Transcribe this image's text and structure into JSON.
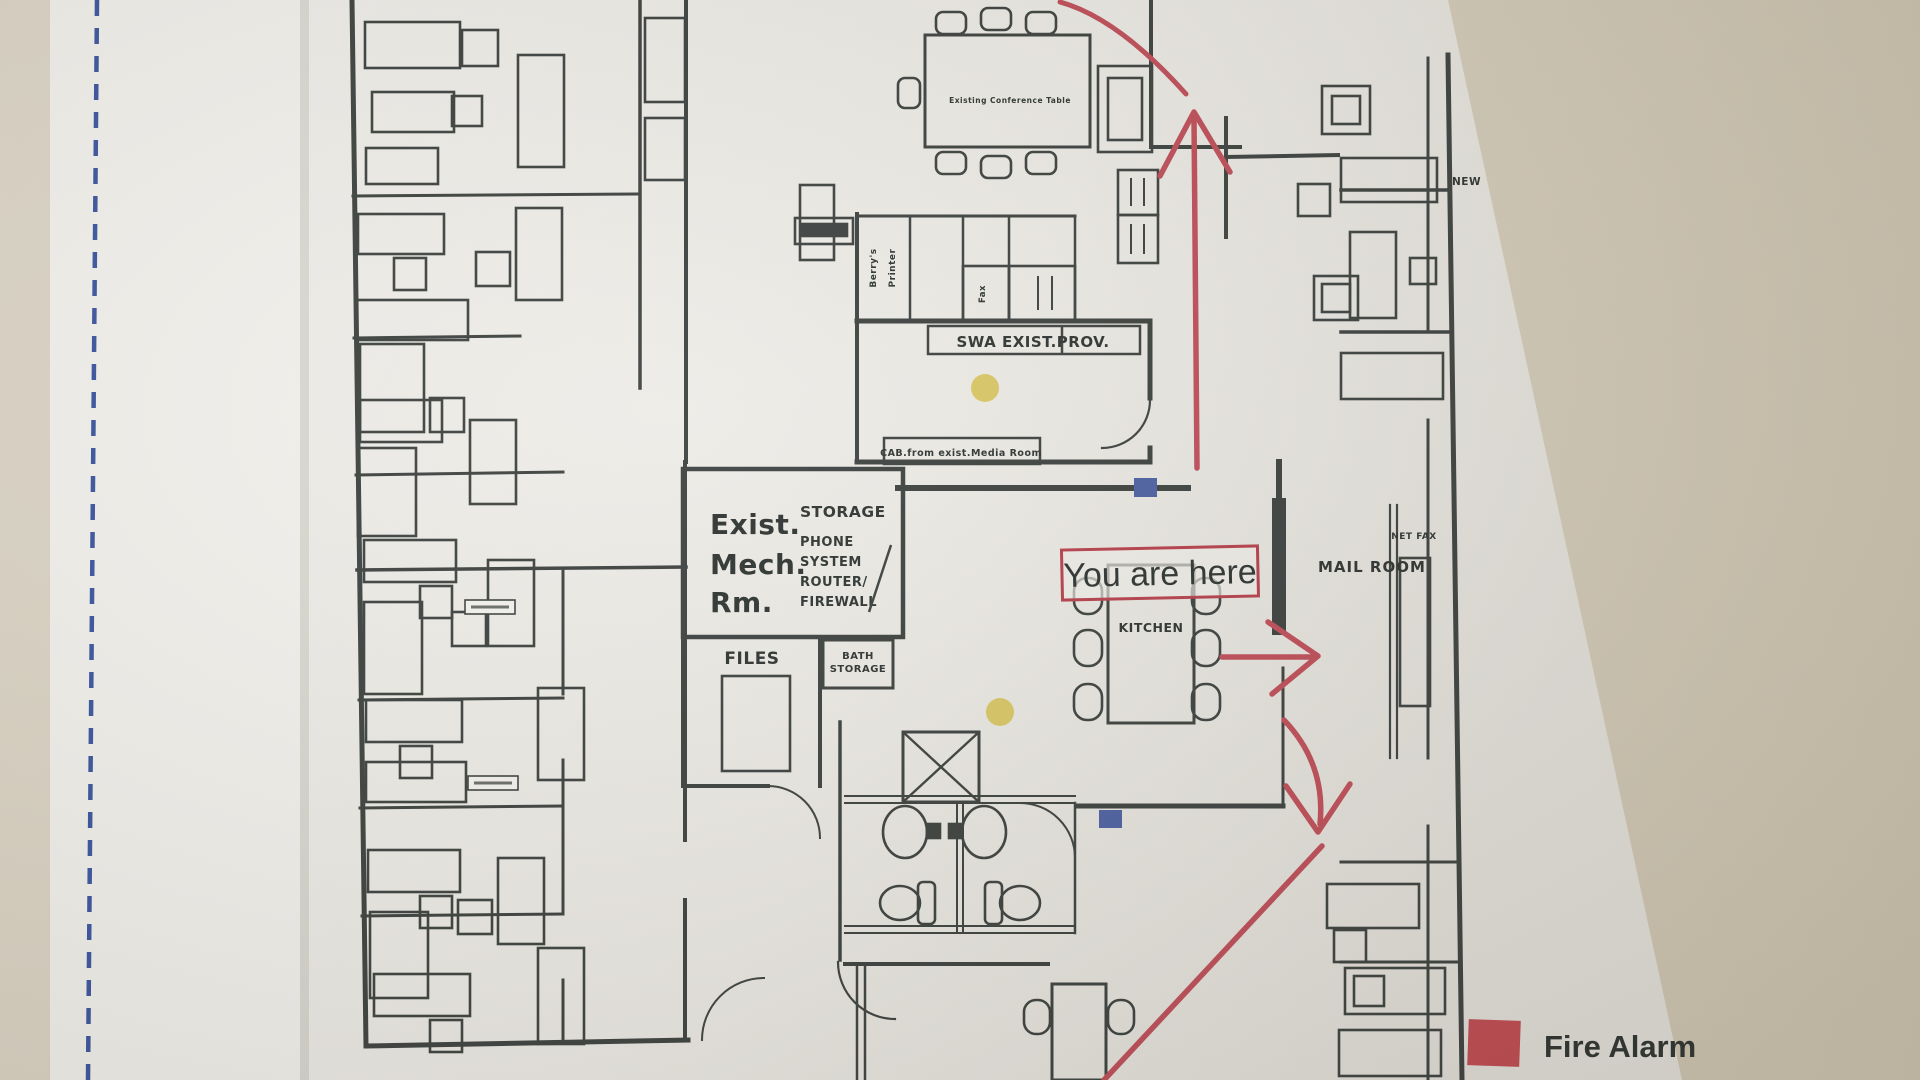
{
  "photo": {
    "background_color": "#d9d1c1",
    "paper_color": "#edece8",
    "ink_color": "#3d4240",
    "route_red": "#bf4e59",
    "fire_alarm_red": "#c04b52",
    "marker_blue": "#4d61a3",
    "highlighter_yellow": "#d8c55e",
    "margin_dash_blue": "#3b55a0"
  },
  "plan": {
    "rooms": {
      "swa_label": "SWA EXIST.PROV.",
      "cab_label": "CAB.from exist.Media Room",
      "mech_room": [
        "Exist.",
        "Mech.",
        "Rm."
      ],
      "mech_storage": [
        "STORAGE",
        "PHONE",
        "SYSTEM",
        "ROUTER/",
        "FIREWALL"
      ],
      "files_label": "FILES",
      "bath_storage": [
        "BATH",
        "STORAGE"
      ],
      "kitchen_label": "KITCHEN",
      "mail_room_label": "MAIL ROOM",
      "net_fax_label": "NET FAX",
      "new_label": "NEW",
      "printer_closet": [
        "Berry's",
        "Printer"
      ],
      "fax_label": "Fax",
      "conference_note": "Existing Conference Table"
    },
    "annotations": {
      "you_are_here": "You are here"
    },
    "legend": {
      "fire_alarm": "Fire Alarm"
    }
  }
}
